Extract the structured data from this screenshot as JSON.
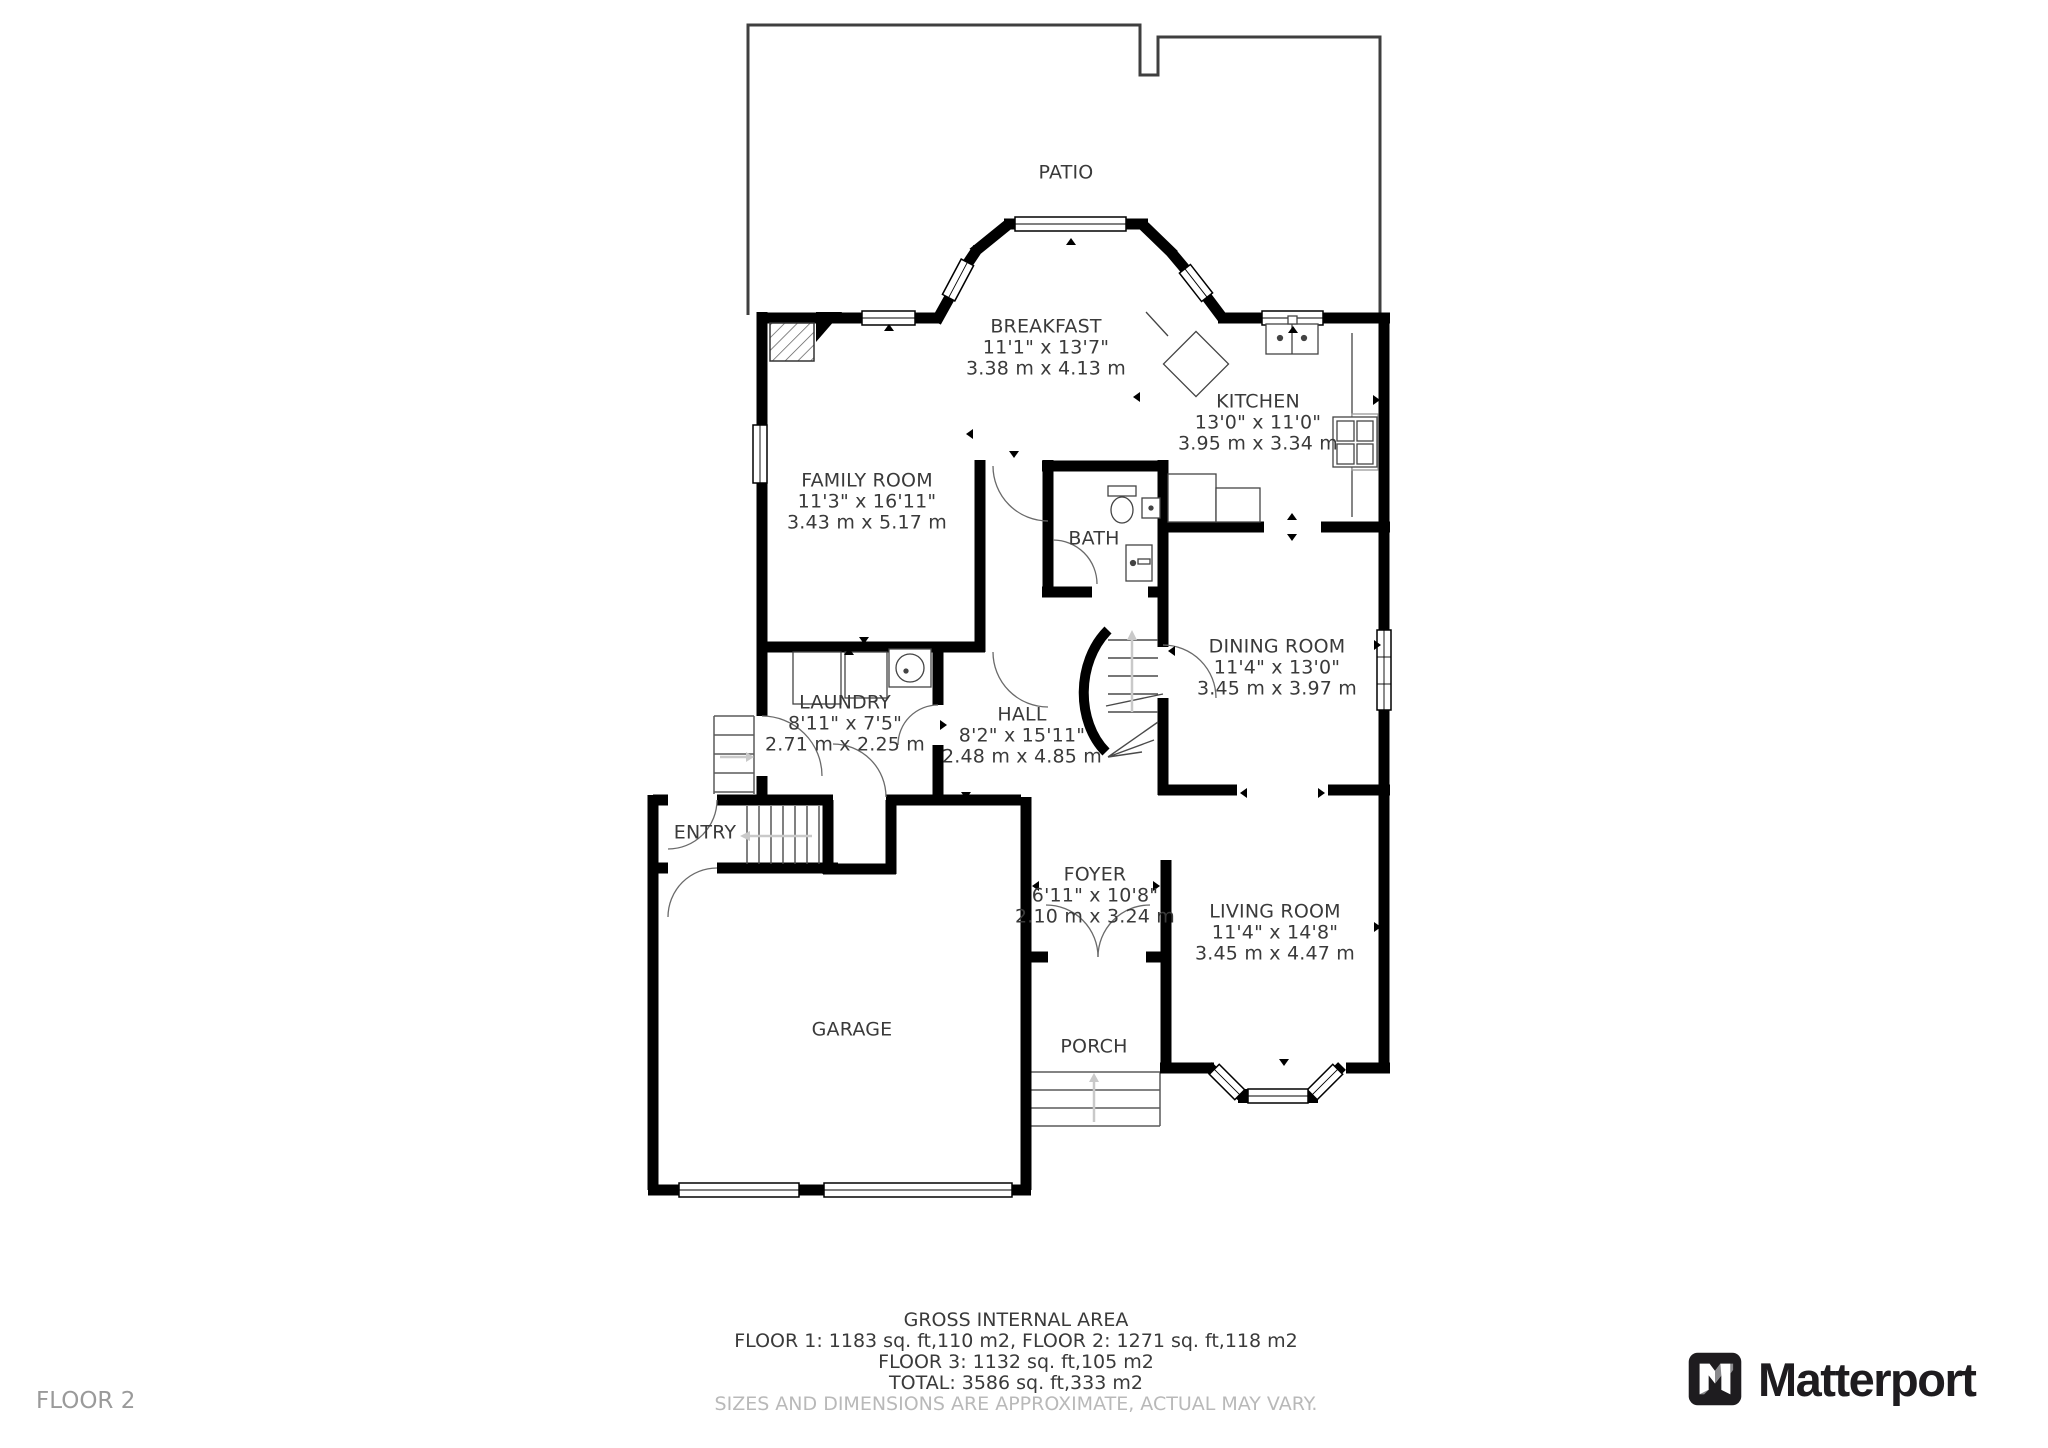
{
  "page": {
    "floor_label": "FLOOR 2"
  },
  "brand": {
    "name": "Matterport"
  },
  "rooms": {
    "patio": {
      "label": "PATIO"
    },
    "breakfast": {
      "label": "BREAKFAST",
      "size_ft": "11'1\" x 13'7\"",
      "size_m": "3.38 m x 4.13 m"
    },
    "kitchen": {
      "label": "KITCHEN",
      "size_ft": "13'0\" x 11'0\"",
      "size_m": "3.95 m x 3.34 m"
    },
    "family_room": {
      "label": "FAMILY ROOM",
      "size_ft": "11'3\" x 16'11\"",
      "size_m": "3.43 m x 5.17 m"
    },
    "bath": {
      "label": "BATH"
    },
    "dining_room": {
      "label": "DINING ROOM",
      "size_ft": "11'4\" x 13'0\"",
      "size_m": "3.45 m x 3.97 m"
    },
    "laundry": {
      "label": "LAUNDRY",
      "size_ft": "8'11\" x 7'5\"",
      "size_m": "2.71 m x 2.25 m"
    },
    "hall": {
      "label": "HALL",
      "size_ft": "8'2\" x 15'11\"",
      "size_m": "2.48 m x 4.85 m"
    },
    "entry": {
      "label": "ENTRY"
    },
    "foyer": {
      "label": "FOYER",
      "size_ft": "6'11\" x 10'8\"",
      "size_m": "2.10 m x 3.24 m"
    },
    "garage": {
      "label": "GARAGE"
    },
    "porch": {
      "label": "PORCH"
    },
    "living_room": {
      "label": "LIVING ROOM",
      "size_ft": "11'4\" x 14'8\"",
      "size_m": "3.45 m x 4.47 m"
    }
  },
  "footer": {
    "title": "GROSS INTERNAL AREA",
    "line1": "FLOOR 1: 1183 sq. ft,110 m2, FLOOR 2: 1271 sq. ft,118 m2",
    "line2": "FLOOR 3: 1132 sq. ft,105 m2",
    "line3": "TOTAL: 3586 sq. ft,333 m2",
    "disclaimer": "SIZES AND DIMENSIONS ARE APPROXIMATE, ACTUAL MAY VARY."
  },
  "colors": {
    "wall": "#000000",
    "text": "#3a3a3a",
    "muted": "#b9b9b9",
    "floor_label": "#9a9a9a",
    "brand": "#1e1c1f"
  }
}
